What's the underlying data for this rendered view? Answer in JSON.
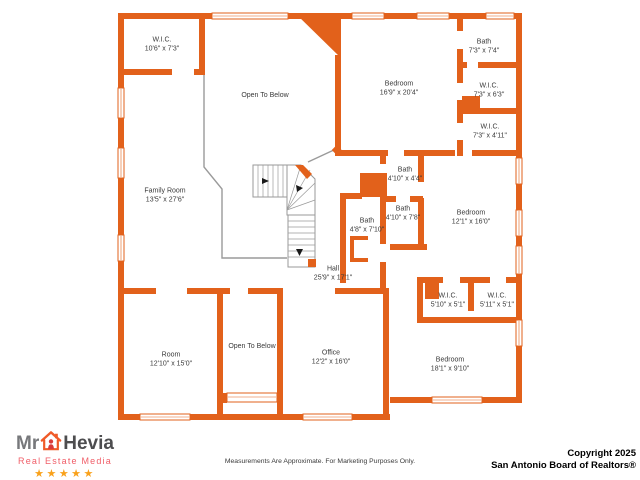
{
  "colors": {
    "wall": "#E2611B",
    "railing": "#9a9a9a",
    "label_text": "#3a3a3a",
    "logo_gray": "#77787B",
    "logo_dark": "#4D4D4F",
    "logo_red": "#F05E68",
    "logo_house": "#F05A28",
    "logo_person": "#D93B3B",
    "star_gold": "#F9A11B",
    "copyright_text": "#000000"
  },
  "rooms": [
    {
      "name": "W.I.C.",
      "dims": "10'6\" x 7'3\"",
      "x": 162,
      "y": 45
    },
    {
      "name": "Open To Below",
      "dims": "",
      "x": 265,
      "y": 96
    },
    {
      "name": "Bedroom",
      "dims": "16'9\" x 20'4\"",
      "x": 399,
      "y": 89
    },
    {
      "name": "Bath",
      "dims": "7'3\" x 7'4\"",
      "x": 484,
      "y": 47
    },
    {
      "name": "W.I.C.",
      "dims": "7'3\" x 6'3\"",
      "x": 489,
      "y": 91
    },
    {
      "name": "W.I.C.",
      "dims": "7'3\" x 4'11\"",
      "x": 490,
      "y": 132
    },
    {
      "name": "Family Room",
      "dims": "13'5\" x 27'6\"",
      "x": 165,
      "y": 196
    },
    {
      "name": "Bath",
      "dims": "4'10\" x 4'4\"",
      "x": 405,
      "y": 175
    },
    {
      "name": "Bath",
      "dims": "4'10\" x 7'8\"",
      "x": 403,
      "y": 214
    },
    {
      "name": "Bath",
      "dims": "4'8\" x 7'10\"",
      "x": 367,
      "y": 226
    },
    {
      "name": "Bedroom",
      "dims": "12'1\" x 16'0\"",
      "x": 471,
      "y": 218
    },
    {
      "name": "Hall",
      "dims": "25'9\" x 17'1\"",
      "x": 333,
      "y": 274
    },
    {
      "name": "W.I.C.",
      "dims": "5'10\" x 5'1\"",
      "x": 448,
      "y": 301
    },
    {
      "name": "W.I.C.",
      "dims": "5'11\" x 5'1\"",
      "x": 497,
      "y": 301
    },
    {
      "name": "Room",
      "dims": "12'10\" x 15'0\"",
      "x": 171,
      "y": 360
    },
    {
      "name": "Open To Below",
      "dims": "",
      "x": 252,
      "y": 347
    },
    {
      "name": "Office",
      "dims": "12'2\" x 16'0\"",
      "x": 331,
      "y": 358
    },
    {
      "name": "Bedroom",
      "dims": "18'1\" x 9'10\"",
      "x": 450,
      "y": 365
    }
  ],
  "logo": {
    "prefix": "Mr",
    "name": "Hevia",
    "tagline": "Real Estate Media",
    "stars": "★★★★★",
    "icon": "house-with-person-icon"
  },
  "footer": {
    "disclaimer": "Measurements Are Approximate. For Marketing Purposes Only.",
    "copyright_line1": "Copyright 2025",
    "copyright_line2": "San Antonio Board of Realtors®"
  }
}
